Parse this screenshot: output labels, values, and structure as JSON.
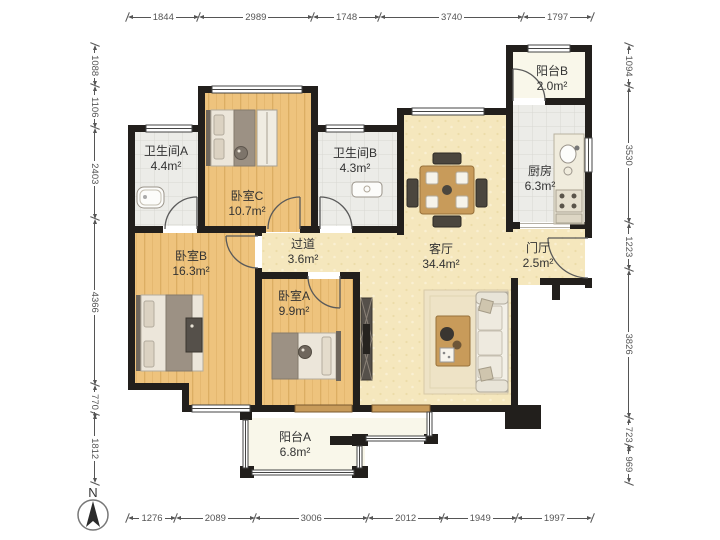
{
  "compass": {
    "label": "N"
  },
  "rooms": [
    {
      "name": "卫生间A",
      "area": "4.4m²"
    },
    {
      "name": "卧室C",
      "area": "10.7m²"
    },
    {
      "name": "卫生间B",
      "area": "4.3m²"
    },
    {
      "name": "阳台B",
      "area": "2.0m²"
    },
    {
      "name": "厨房",
      "area": "6.3m²"
    },
    {
      "name": "过道",
      "area": "3.6m²"
    },
    {
      "name": "客厅",
      "area": "34.4m²"
    },
    {
      "name": "门厅",
      "area": "2.5m²"
    },
    {
      "name": "卧室B",
      "area": "16.3m²"
    },
    {
      "name": "卧室A",
      "area": "9.9m²"
    },
    {
      "name": "阳台A",
      "area": "6.8m²"
    }
  ],
  "dimensions": {
    "top": [
      "1844",
      "2989",
      "1748",
      "3740",
      "1797"
    ],
    "bottom": [
      "1276",
      "2089",
      "3006",
      "2012",
      "1949",
      "1997"
    ],
    "left": [
      "1088",
      "1106",
      "2403",
      "4366",
      "770",
      "1812"
    ],
    "right": [
      "1094",
      "3530",
      "1223",
      "3826",
      "723",
      "969"
    ]
  },
  "colors": {
    "wall": "#221f1c",
    "wood_floor": "#eec37d",
    "wood_grain": "#dcae63",
    "tile_floor": "#ecece8",
    "tile_line": "#d8d7d2",
    "living_floor": "#f5e7bd",
    "living_speck": "#ecdca8",
    "balcony_floor": "#f9f7ea",
    "window_sill": "#c89b5a",
    "dimension": "#555555",
    "label": "#333333"
  }
}
